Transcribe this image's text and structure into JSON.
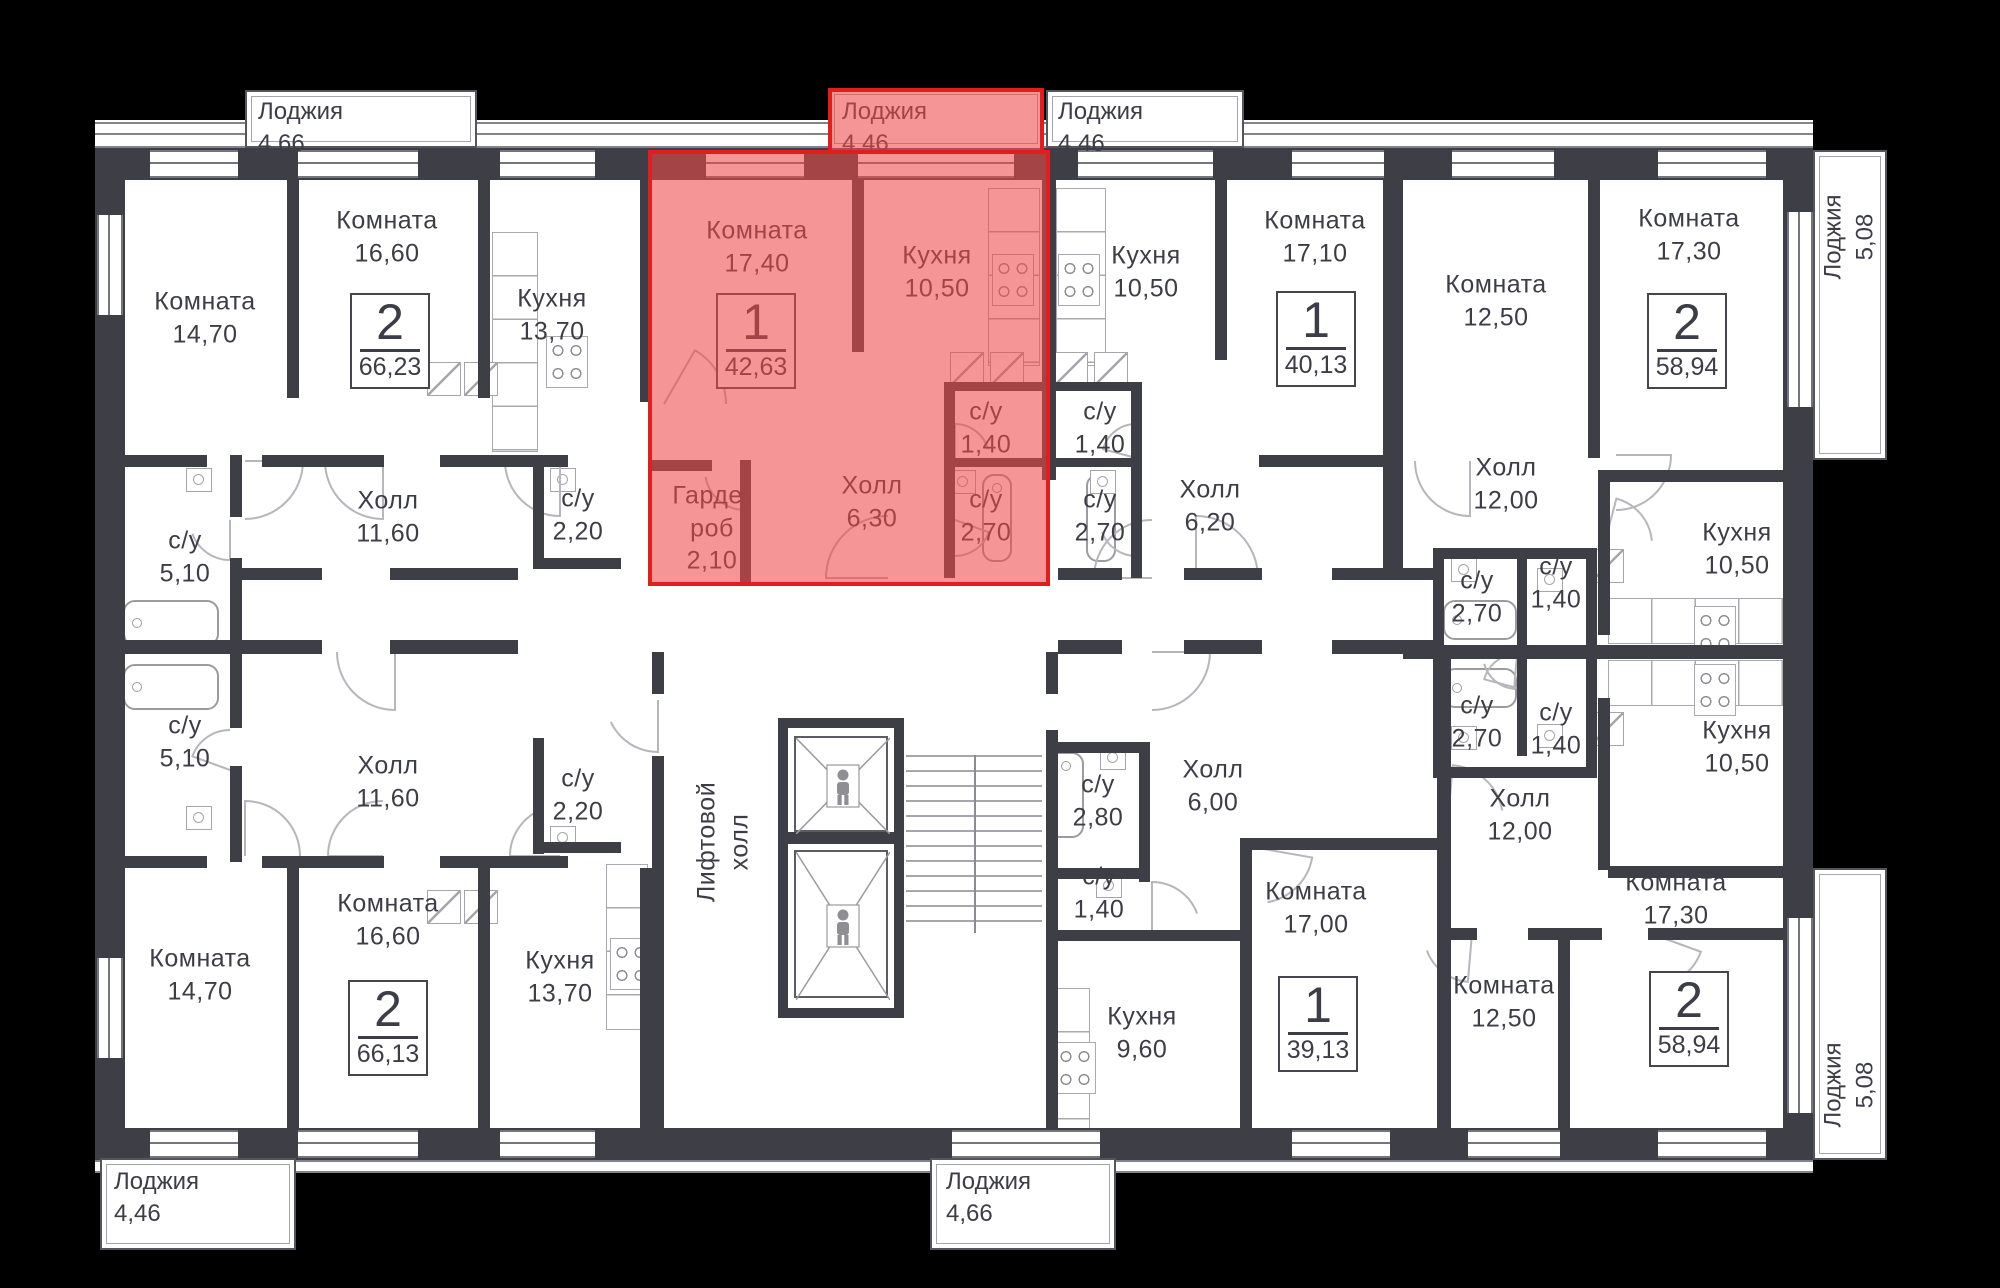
{
  "floorplan": {
    "background": "#000000",
    "wall_color": "#3e3e46",
    "text_color": "#3d3d47",
    "highlight": {
      "fill": "rgba(238,72,72,0.58)",
      "border": "#e21d1d"
    },
    "apartment_badges": [
      {
        "rooms": "2",
        "area": "66,23",
        "x": 350,
        "y": 293,
        "highlighted": false
      },
      {
        "rooms": "1",
        "area": "42,63",
        "x": 716,
        "y": 293,
        "highlighted": true
      },
      {
        "rooms": "1",
        "area": "40,13",
        "x": 1276,
        "y": 291,
        "highlighted": false
      },
      {
        "rooms": "2",
        "area": "58,94",
        "x": 1647,
        "y": 293,
        "highlighted": false
      },
      {
        "rooms": "2",
        "area": "66,13",
        "x": 348,
        "y": 980,
        "highlighted": false
      },
      {
        "rooms": "1",
        "area": "39,13",
        "x": 1278,
        "y": 976,
        "highlighted": false
      },
      {
        "rooms": "2",
        "area": "58,94",
        "x": 1649,
        "y": 971,
        "highlighted": false
      }
    ],
    "rooms": [
      {
        "label": "Комната",
        "area": "14,70",
        "x": 205,
        "y": 318,
        "hl": false,
        "v": false
      },
      {
        "label": "Комната",
        "area": "16,60",
        "x": 387,
        "y": 237,
        "hl": false,
        "v": false
      },
      {
        "label": "Кухня",
        "area": "13,70",
        "x": 552,
        "y": 315,
        "hl": false,
        "v": false
      },
      {
        "label": "Комната",
        "area": "17,40",
        "x": 757,
        "y": 247,
        "hl": true,
        "v": false
      },
      {
        "label": "Кухня",
        "area": "10,50",
        "x": 937,
        "y": 272,
        "hl": true,
        "v": false
      },
      {
        "label": "Гарде-\nроб",
        "area": "2,10",
        "x": 712,
        "y": 528,
        "hl": true,
        "v": false
      },
      {
        "label": "Холл",
        "area": "6,30",
        "x": 872,
        "y": 502,
        "hl": true,
        "v": false
      },
      {
        "label": "с/у",
        "area": "1,40",
        "x": 986,
        "y": 428,
        "hl": true,
        "v": false
      },
      {
        "label": "с/у",
        "area": "2,70",
        "x": 986,
        "y": 516,
        "hl": true,
        "v": false
      },
      {
        "label": "Кухня",
        "area": "10,50",
        "x": 1146,
        "y": 272,
        "hl": false,
        "v": false
      },
      {
        "label": "с/у",
        "area": "1,40",
        "x": 1100,
        "y": 428,
        "hl": false,
        "v": false
      },
      {
        "label": "с/у",
        "area": "2,70",
        "x": 1100,
        "y": 516,
        "hl": false,
        "v": false
      },
      {
        "label": "Холл",
        "area": "6,20",
        "x": 1210,
        "y": 506,
        "hl": false,
        "v": false
      },
      {
        "label": "Комната",
        "area": "17,10",
        "x": 1315,
        "y": 237,
        "hl": false,
        "v": false
      },
      {
        "label": "Комната",
        "area": "12,50",
        "x": 1496,
        "y": 301,
        "hl": false,
        "v": false
      },
      {
        "label": "Холл",
        "area": "12,00",
        "x": 1506,
        "y": 484,
        "hl": false,
        "v": false
      },
      {
        "label": "с/у",
        "area": "2,70",
        "x": 1477,
        "y": 597,
        "hl": false,
        "v": false
      },
      {
        "label": "с/у",
        "area": "1,40",
        "x": 1556,
        "y": 583,
        "hl": false,
        "v": false
      },
      {
        "label": "Кухня",
        "area": "10,50",
        "x": 1737,
        "y": 549,
        "hl": false,
        "v": false
      },
      {
        "label": "Комната",
        "area": "17,30",
        "x": 1689,
        "y": 235,
        "hl": false,
        "v": false
      },
      {
        "label": "с/у",
        "area": "5,10",
        "x": 185,
        "y": 557,
        "hl": false,
        "v": false
      },
      {
        "label": "Холл",
        "area": "11,60",
        "x": 388,
        "y": 517,
        "hl": false,
        "v": false
      },
      {
        "label": "с/у",
        "area": "2,20",
        "x": 578,
        "y": 515,
        "hl": false,
        "v": false
      },
      {
        "label": "с/у",
        "area": "5,10",
        "x": 185,
        "y": 742,
        "hl": false,
        "v": false
      },
      {
        "label": "Холл",
        "area": "11,60",
        "x": 388,
        "y": 782,
        "hl": false,
        "v": false
      },
      {
        "label": "с/у",
        "area": "2,20",
        "x": 578,
        "y": 795,
        "hl": false,
        "v": false
      },
      {
        "label": "Лифтовой\nхолл",
        "area": "",
        "x": 723,
        "y": 842,
        "hl": false,
        "v": true
      },
      {
        "label": "с/у",
        "area": "2,70",
        "x": 1477,
        "y": 722,
        "hl": false,
        "v": false
      },
      {
        "label": "с/у",
        "area": "1,40",
        "x": 1556,
        "y": 729,
        "hl": false,
        "v": false
      },
      {
        "label": "Кухня",
        "area": "10,50",
        "x": 1737,
        "y": 747,
        "hl": false,
        "v": false
      },
      {
        "label": "Холл",
        "area": "12,00",
        "x": 1520,
        "y": 815,
        "hl": false,
        "v": false
      },
      {
        "label": "Комната",
        "area": "14,70",
        "x": 200,
        "y": 975,
        "hl": false,
        "v": false
      },
      {
        "label": "Комната",
        "area": "16,60",
        "x": 388,
        "y": 920,
        "hl": false,
        "v": false
      },
      {
        "label": "Кухня",
        "area": "13,70",
        "x": 560,
        "y": 977,
        "hl": false,
        "v": false
      },
      {
        "label": "с/у",
        "area": "2,80",
        "x": 1098,
        "y": 801,
        "hl": false,
        "v": false
      },
      {
        "label": "Холл",
        "area": "6,00",
        "x": 1213,
        "y": 786,
        "hl": false,
        "v": false
      },
      {
        "label": "с/у",
        "area": "1,40",
        "x": 1099,
        "y": 893,
        "hl": false,
        "v": false
      },
      {
        "label": "Кухня",
        "area": "9,60",
        "x": 1142,
        "y": 1033,
        "hl": false,
        "v": false
      },
      {
        "label": "Комната",
        "area": "17,00",
        "x": 1316,
        "y": 908,
        "hl": false,
        "v": false
      },
      {
        "label": "Комната",
        "area": "12,50",
        "x": 1504,
        "y": 1002,
        "hl": false,
        "v": false
      },
      {
        "label": "Комната",
        "area": "17,30",
        "x": 1676,
        "y": 899,
        "hl": false,
        "v": false
      }
    ],
    "loggias": [
      {
        "label": "Лоджия",
        "area": "4,66",
        "x": 245,
        "y": 90,
        "w": 232,
        "h": 58,
        "v": false,
        "hl": false,
        "lx": 258,
        "ly": 96
      },
      {
        "label": "Лоджия",
        "area": "4,46",
        "x": 828,
        "y": 88,
        "w": 216,
        "h": 62,
        "v": false,
        "hl": true,
        "lx": 842,
        "ly": 96
      },
      {
        "label": "Лоджия",
        "area": "4,46",
        "x": 1046,
        "y": 90,
        "w": 198,
        "h": 58,
        "v": false,
        "hl": false,
        "lx": 1058,
        "ly": 96
      },
      {
        "label": "Лоджия",
        "area": "5,08",
        "x": 1813,
        "y": 150,
        "w": 74,
        "h": 310,
        "v": true,
        "hl": false,
        "lx": 1850,
        "ly": 237
      },
      {
        "label": "Лоджия",
        "area": "5,08",
        "x": 1813,
        "y": 868,
        "w": 74,
        "h": 292,
        "v": true,
        "hl": false,
        "lx": 1850,
        "ly": 1085
      },
      {
        "label": "Лоджия",
        "area": "4,46",
        "x": 100,
        "y": 1158,
        "w": 196,
        "h": 92,
        "v": false,
        "hl": false,
        "lx": 114,
        "ly": 1166
      },
      {
        "label": "Лоджия",
        "area": "4,66",
        "x": 930,
        "y": 1158,
        "w": 186,
        "h": 92,
        "v": false,
        "hl": false,
        "lx": 946,
        "ly": 1166
      }
    ]
  }
}
